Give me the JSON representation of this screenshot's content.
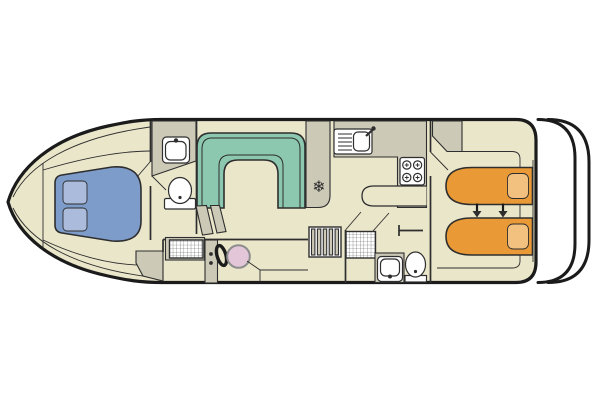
{
  "page": {
    "background": "#ffffff"
  },
  "colors": {
    "page_bg": "#ffffff",
    "outline": "#1b1b1b",
    "line": "#2e2e2e",
    "floor": "#eae6ca",
    "utility": "#ccc9b7",
    "sofa": "#8cc7b0",
    "bed_front": "#7e9cca",
    "pillow_front": "#abbbdb",
    "bed_rear": "#e99a36",
    "pillow_rear": "#f2c07f",
    "helm_seat": "#e3c7d8",
    "fixture": "#ffffff"
  },
  "icons": {
    "fridge_snowflake": "❄"
  },
  "boat": {
    "areas": [
      "bow-cabin",
      "front-bathroom",
      "saloon",
      "galley",
      "helm",
      "rear-bathroom",
      "rear-cabin",
      "stern-swim-platform"
    ],
    "fixtures": [
      "double-bed-with-two-pillows",
      "washbasin",
      "toilet",
      "u-shaped-dinette",
      "companionway-steps",
      "shower-tray",
      "galley-sink-with-drainer",
      "four-burner-stove",
      "fridge",
      "helm-console",
      "steering-wheel",
      "helm-seat",
      "rear-shower-tray",
      "rear-washbasin",
      "rear-toilet",
      "two-single-beds-sliding-together",
      "wardrobe"
    ],
    "bed_slide_arrows": 2
  }
}
